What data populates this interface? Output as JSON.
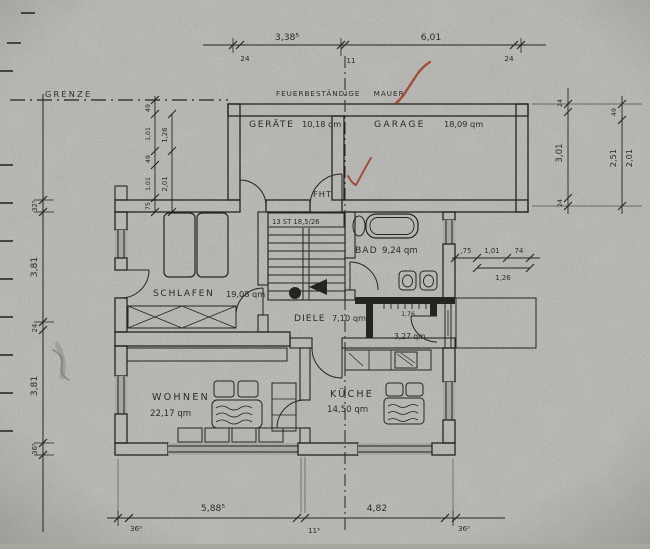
{
  "annotations": {
    "grenze": "GRENZE",
    "firewall": "FEUERBESTÄNDIGE MAUER",
    "entry_door": "FHT",
    "stairs": "13 ST 18,5/26"
  },
  "rooms": {
    "geraete": {
      "name": "GERÄTE",
      "area": "10,18 qm"
    },
    "garage": {
      "name": "GARAGE",
      "area": "18,09 qm"
    },
    "bad": {
      "name": "BAD",
      "area": "9,24 qm"
    },
    "schlafen": {
      "name": "SCHLAFEN",
      "area": "19,08 qm"
    },
    "diele": {
      "name": "DIELE",
      "area": "7,10 qm"
    },
    "wc": {
      "area": "3,27 qm"
    },
    "wohnen": {
      "name": "WOHNEN",
      "area": "22,17 qm"
    },
    "kueche": {
      "name": "KÜCHE",
      "area": "14,50 qm"
    }
  },
  "dimensions": {
    "top": {
      "segments": [
        "3,38⁵",
        "6,01"
      ],
      "ticks": [
        "24",
        "11",
        "24"
      ]
    },
    "bottom": {
      "segments": [
        "5,88⁵",
        "4,82"
      ],
      "ticks": [
        "36⁵",
        "11⁵",
        "36⁵"
      ]
    },
    "left": {
      "labels": [
        "32⁵",
        "3,81",
        "24",
        "3,81",
        "36⁵"
      ]
    },
    "left_entry": {
      "inner": [
        "49",
        "1,01",
        "49",
        "1,01",
        "75"
      ],
      "outer": [
        "1,26",
        "2,01"
      ]
    },
    "right_garage": [
      "24",
      "3,01",
      "24"
    ],
    "right_house": [
      "49",
      "2,51",
      "2,01"
    ],
    "bath_window": {
      "upper": [
        ",75",
        "1,01",
        "74"
      ],
      "lower": "1,26"
    },
    "hook_rail": "1,76"
  },
  "colors": {
    "paper": "#a7a6a1",
    "ink": "#26241f",
    "red_mark": "#9e3a2c"
  }
}
